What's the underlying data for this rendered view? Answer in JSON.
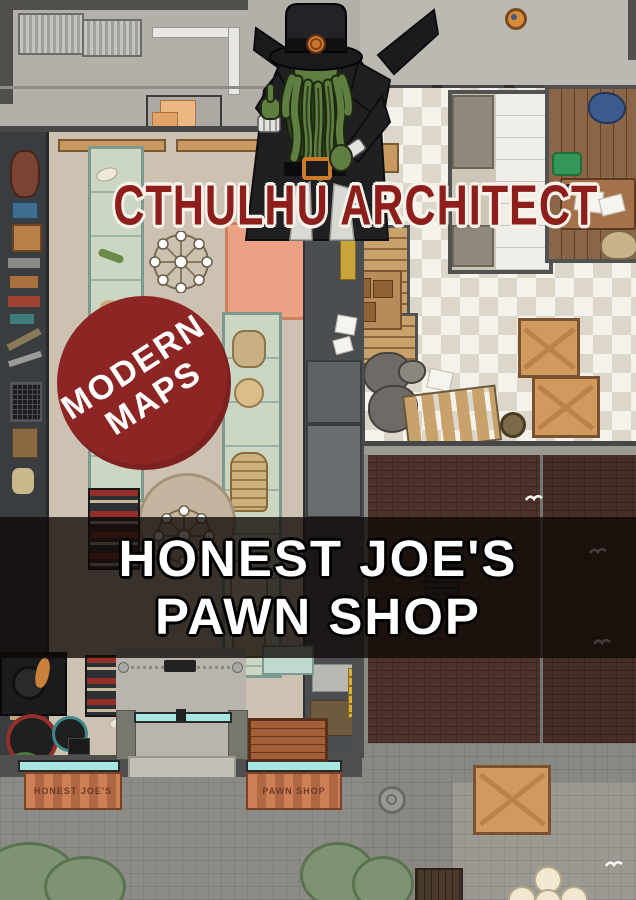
{
  "branding": {
    "logo_text": "CTHULHU ARCHITECT",
    "logo_color": "#8e1e1c",
    "badge": {
      "line1": "MODERN",
      "line2": "MAPS",
      "background": "#8e2525",
      "text_color": "#ffffff"
    },
    "title_banner": {
      "line1": "HONEST JOE'S",
      "line2": "PAWN SHOP",
      "text_color": "#ffffff"
    },
    "mascot": "cthulhu-in-top-hat-and-suit"
  },
  "map": {
    "storefront": {
      "awning_left_label": "HONEST JOE'S",
      "awning_right_label": "PAWN SHOP",
      "awning_color": "#c87b50"
    },
    "palette": {
      "shop_floor": "#cdc2b1",
      "checker_light": "#f5f2ec",
      "checker_dark": "#ddd6ca",
      "brick_road": "#4e332c",
      "plaza": "#8a8883",
      "alley": "#b3b0aa",
      "display_case": "#ccd7c3",
      "wall": "#4f4f4f"
    }
  }
}
